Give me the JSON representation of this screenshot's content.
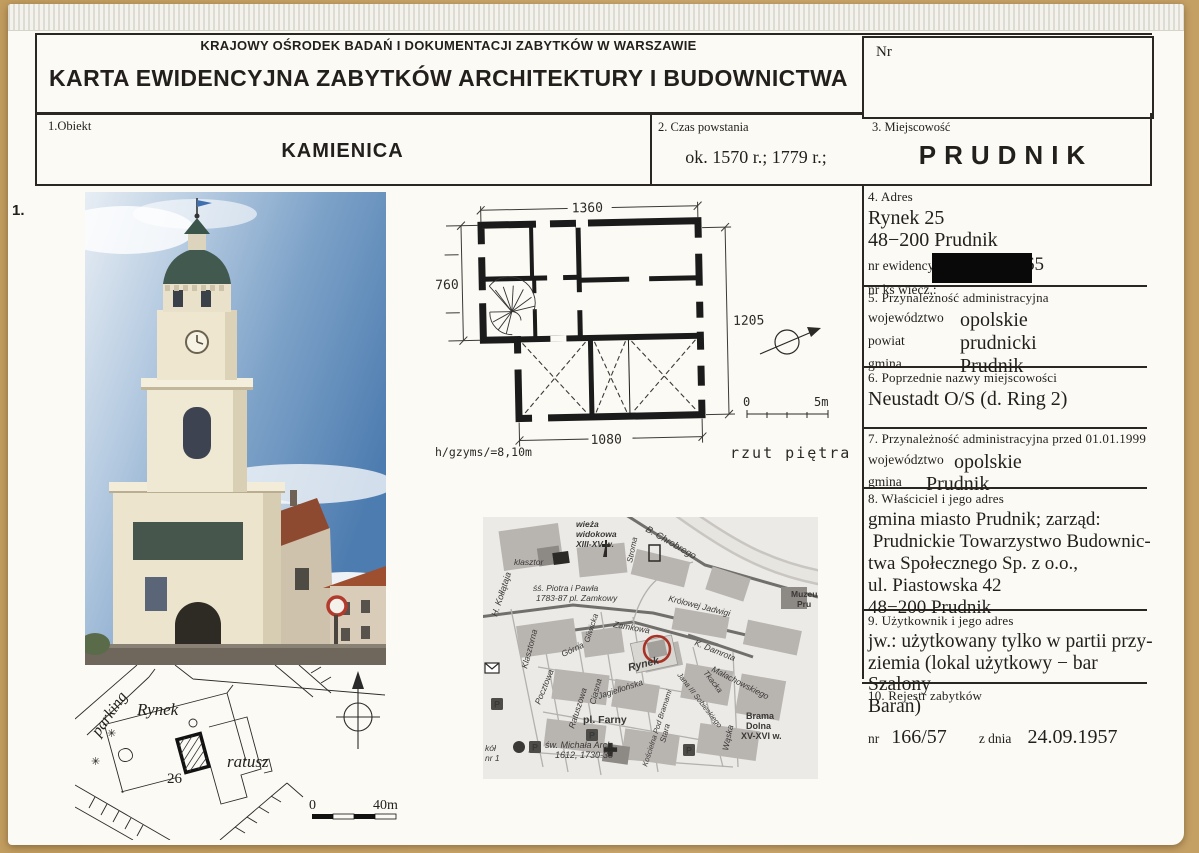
{
  "header": {
    "org": "KRAJOWY OŚRODEK BADAŃ I DOKUMENTACJI ZABYTKÓW W WARSZAWIE",
    "title": "KARTA EWIDENCYJNA ZABYTKÓW ARCHITEKTURY I BUDOWNICTWA",
    "nr_label": "Nr"
  },
  "margin_number": "1.",
  "identity": {
    "object_label": "1.Obiekt",
    "object_value": "KAMIENICA",
    "time_label": "2. Czas powstania",
    "time_value": "ok. 1570 r.; 1779 r.;",
    "place_label": "3. Miejscowość",
    "place_value": "PRUDNIK"
  },
  "fields": {
    "f4": {
      "label": "4. Adres",
      "line1": "Rynek 25",
      "line2": "48−200 Prudnik",
      "plot_label": "nr ewidencyjny działki:",
      "plot_value": "165",
      "mortgage_label": "nr ks wiecz.:"
    },
    "f5": {
      "label": "5. Przynależność administracyjna",
      "r1k": "województwo",
      "r1v": "opolskie",
      "r2k": "powiat",
      "r2v": "prudnicki",
      "r3k": "gmina",
      "r3v": "Prudnik"
    },
    "f6": {
      "label": "6. Poprzednie nazwy miejscowości",
      "value": "Neustadt O/S (d. Ring 2)"
    },
    "f7": {
      "label": "7. Przynależność administracyjna przed 01.01.1999",
      "r1k": "województwo",
      "r1v": "opolskie",
      "r2k": "gmina",
      "r2v": "Prudnik"
    },
    "f8": {
      "label": "8. Właściciel i jego adres",
      "l1": "gmina miasto Prudnik; zarząd:",
      "l2": " Prudnickie Towarzystwo Budownic-",
      "l3": "twa Społecznego Sp. z o.o.,",
      "l4": "ul. Piastowska 42",
      "l5": "48−200 Prudnik"
    },
    "f9": {
      "label": "9. Użytkownik i jego adres",
      "l1": "jw.: użytkowany tylko w partii przy-",
      "l2": "ziemia (lokal użytkowy − bar Szalony",
      "l3": "Baran)"
    },
    "f10": {
      "label": "10. Rejestr zabytków",
      "nr_label": "nr",
      "nr_value": "166/57",
      "date_label": "z dnia",
      "date_value": "24.09.1957"
    }
  },
  "floorplan": {
    "dim_top": "1360",
    "dim_left": "760",
    "dim_right": "1205",
    "dim_bottom": "1080",
    "height_note": "h/gzyms/=8,10m",
    "caption": "rzut piętra",
    "scale_zero": "0",
    "scale_max": "5m"
  },
  "siteplan": {
    "parking": "parking",
    "square": "Rynek",
    "house_number": "26",
    "townhall": "ratusz",
    "scale_zero": "0",
    "scale_max": "40m"
  },
  "map": {
    "kollataja": "H. Kołłątaja",
    "klasztor": "klasztor",
    "piotra": "śś. Piotra i Pawła",
    "zamkowy": "1783-87  pl. Zamkowy",
    "wieza1": "wieża",
    "wieza2": "widokowa",
    "wieza3": "XIII-XV w.",
    "chrobrego": "B. Chrobrego",
    "stroma": "Stroma",
    "jadwigi": "Królowej Jadwigi",
    "zamkowa": "Zamkowa",
    "muzeum1": "Muzeu",
    "muzeum2": "Pru",
    "klasztorna": "Klasztorna",
    "pocztowa": "Pocztowa",
    "gorna": "Górna",
    "gliwicka": "Gliwicka",
    "ciasna": "Ciasna",
    "ratuszowa": "Ratuszowa",
    "jagiellonska": "Jagiellońska",
    "rynek": "Rynek",
    "damrota": "K. Damrota",
    "sobieskiego": "Jana III Sobieskiego",
    "tkacka": "Tkacka",
    "malachowskiego": "Małachowskiego",
    "waska": "Wąska",
    "brama1": "Brama",
    "brama2": "Dolna",
    "brama3": "XV-XVI w.",
    "farny": "pl. Farny",
    "michala": "św. Michała Arch.",
    "michala2": "1612, 1730-38",
    "stara": "Stara",
    "koscielna": "Kościelna Pod Bramami",
    "szkola1": "kół",
    "szkola2": "nr 1",
    "badge_p": "P",
    "badge_i": "i"
  },
  "colors": {
    "accent_red": "#a83226",
    "backing": "#c9a66a",
    "ink": "#2a2621"
  }
}
